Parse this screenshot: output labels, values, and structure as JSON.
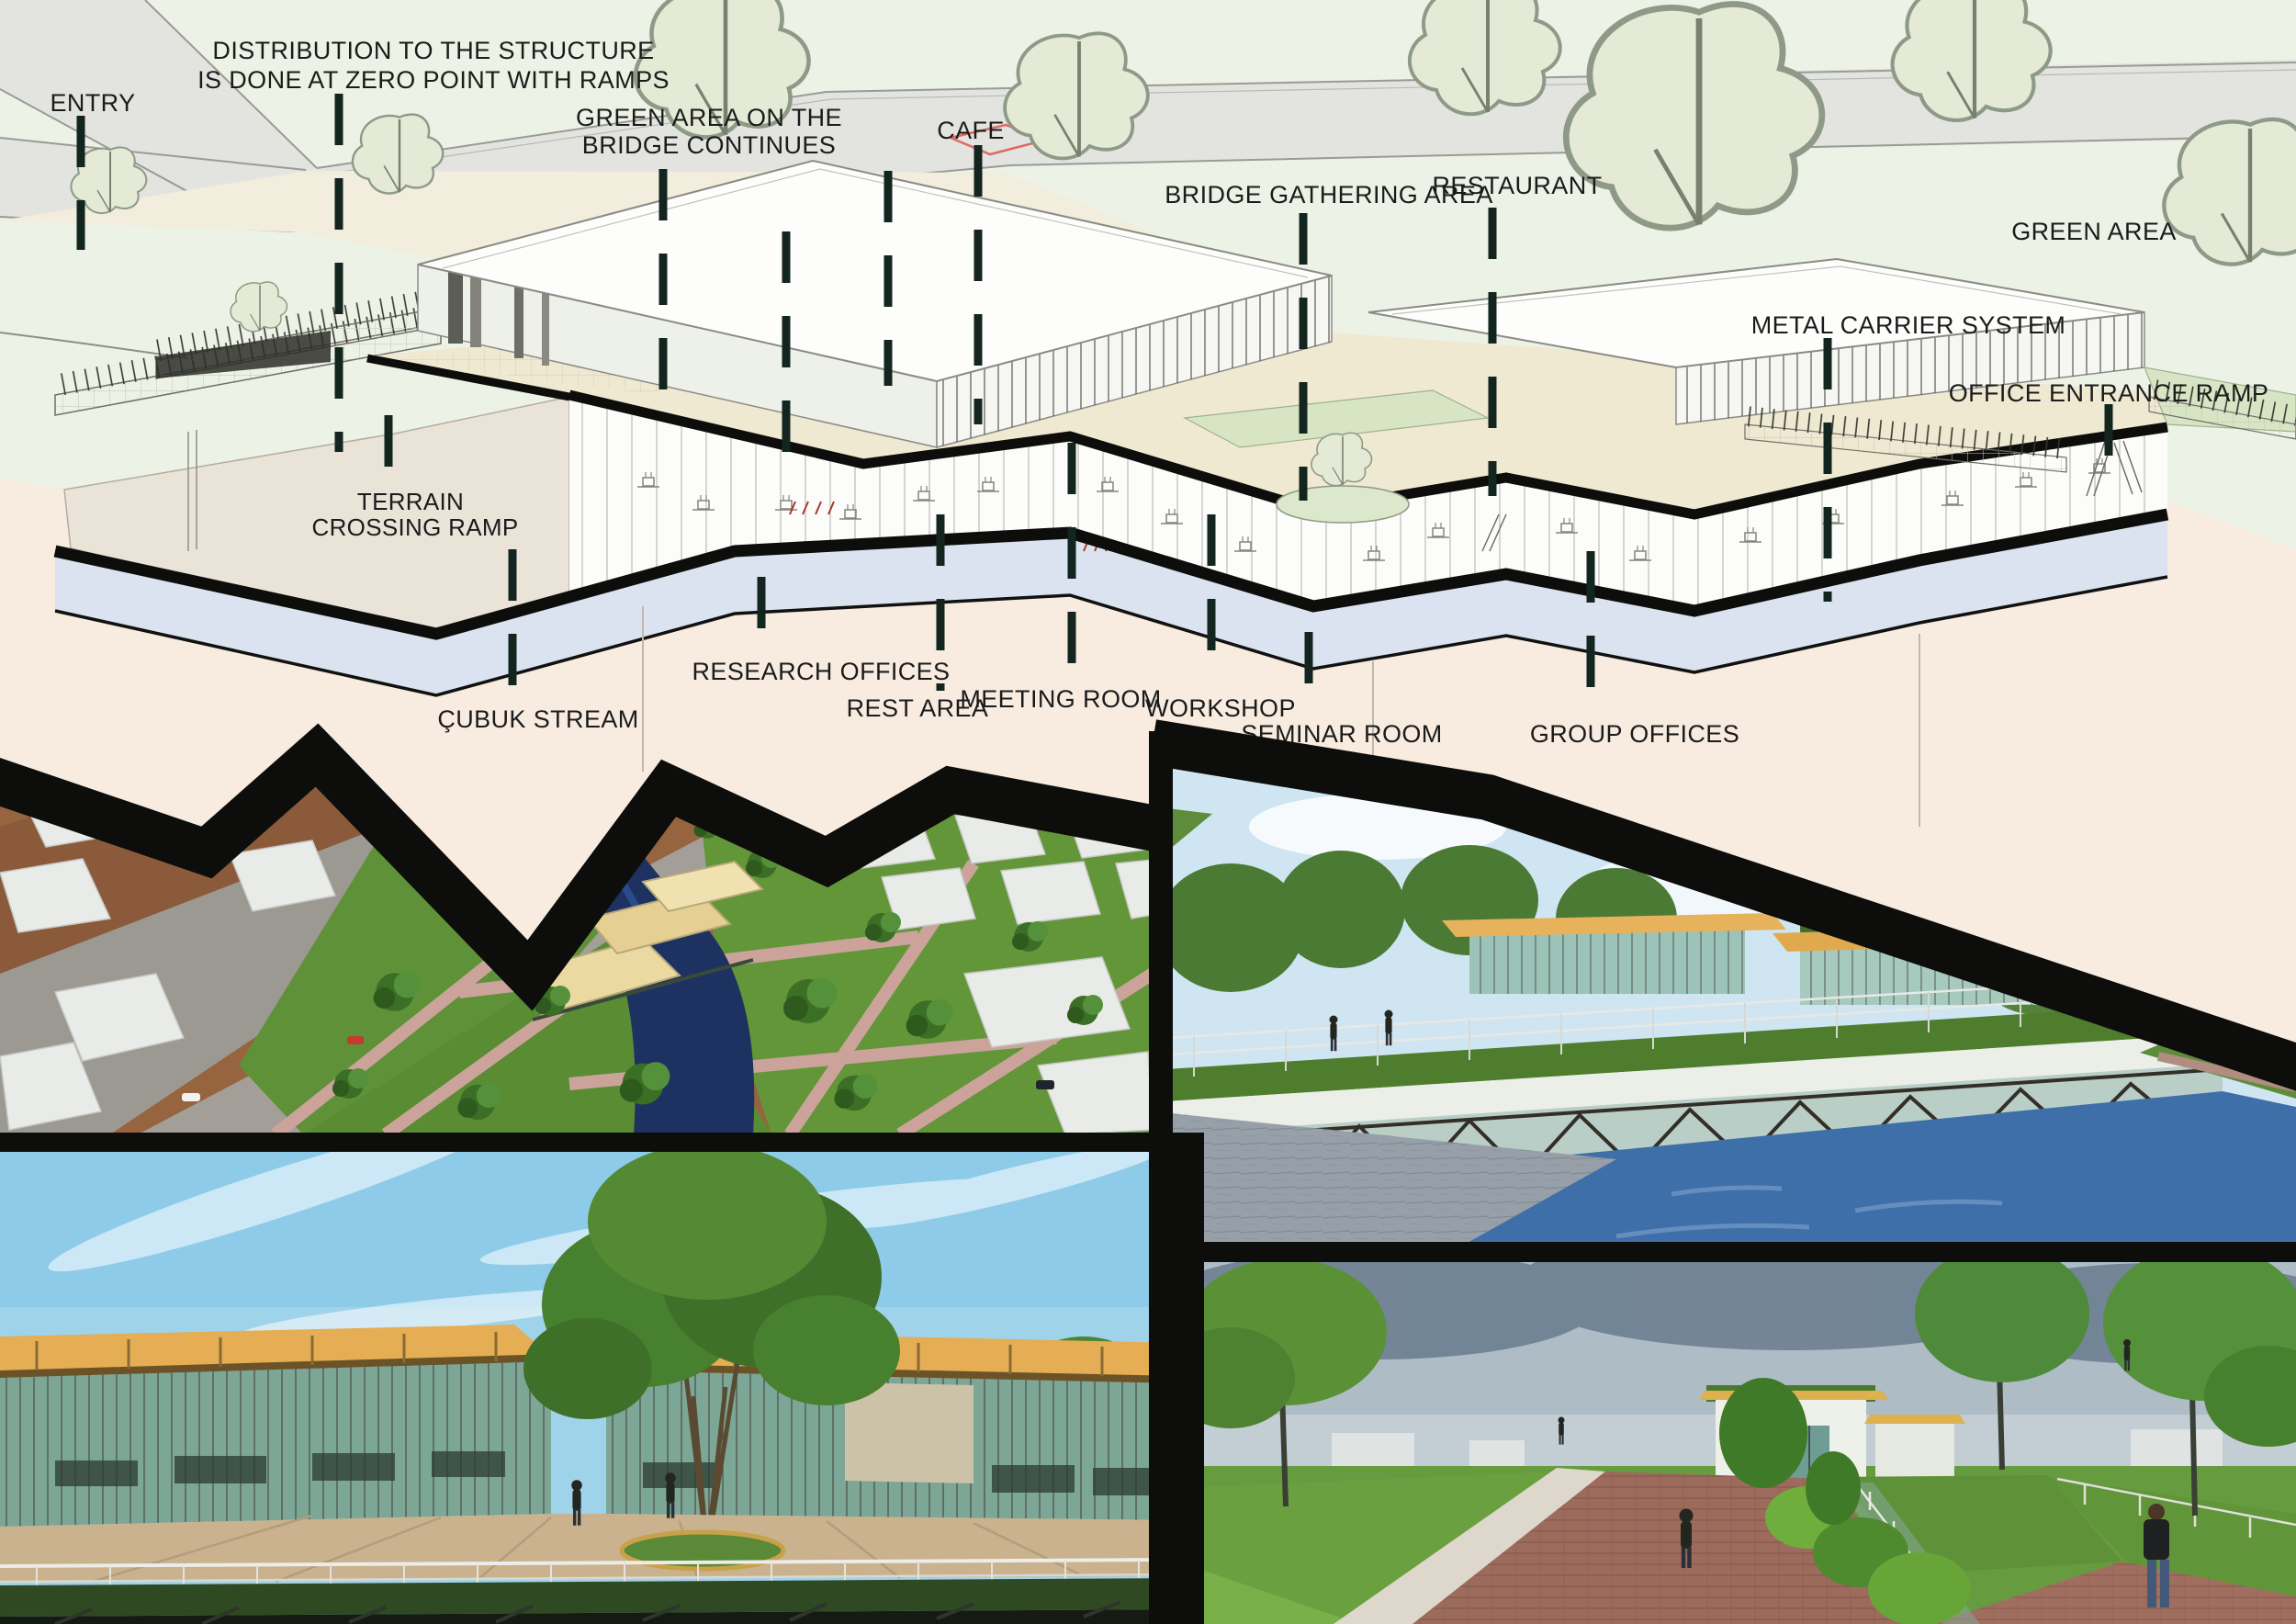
{
  "diagram": {
    "labels": {
      "entry": "ENTRY",
      "distribution_line1": "DISTRIBUTION TO THE STRUCTURE",
      "distribution_line2": "IS DONE AT ZERO POINT WITH RAMPS",
      "green_bridge_line1": "GREEN AREA ON THE",
      "green_bridge_line2": "BRIDGE CONTINUES",
      "cafe": "CAFE",
      "bridge_gathering": "BRIDGE GATHERING AREA",
      "restaurant": "RESTAURANT",
      "green_area": "GREEN AREA",
      "metal_carrier": "METAL CARRIER SYSTEM",
      "office_ramp": "OFFICE ENTRANCE RAMP",
      "terrain_line1": "TERRAIN",
      "terrain_line2": "CROSSING  RAMP",
      "cubuk_stream": "ÇUBUK STREAM",
      "research_offices": "RESEARCH OFFICES",
      "rest_area": "REST AREA",
      "meeting_room": "MEETING ROOM",
      "workshop": "WORKSHOP",
      "seminar_room": "SEMINAR ROOM",
      "group_offices": "GROUP OFFICES"
    }
  },
  "colors": {
    "background_green": "#ecf2e5",
    "road_gray": "#e3e4e0",
    "ground_cream": "#f2eddd",
    "berm_face": "#e9e3d8",
    "terrain_top_lavender": "#dce3f0",
    "terrain_front_pink": "#f7ecdf",
    "deck_cream": "#efe9d2",
    "green_roof": "#d7e5c4",
    "section_black": "#0d0d0b",
    "leader_dash": "#13251f",
    "label_text": "#1b1b1b",
    "roof_yellow": "#e5ad54",
    "water_blue": "#3f6fa8",
    "park_green": "#5f9138",
    "brick_path": "#9c6b5c",
    "sky_blue": "#9fd3ea",
    "storm_sky": "#8da2b2"
  }
}
